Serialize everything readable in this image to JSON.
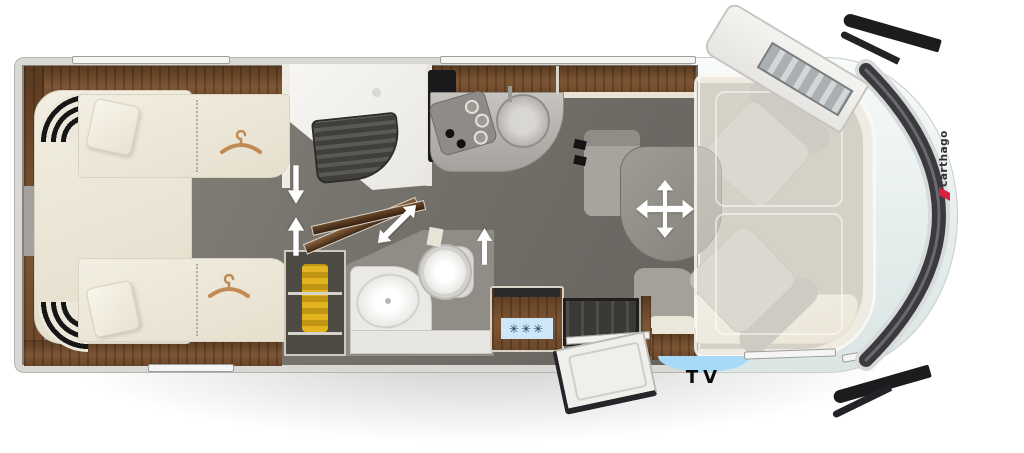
{
  "meta": {
    "type": "motorhome-floor-plan",
    "view": "top-down"
  },
  "labels": {
    "tv": "TV"
  },
  "brand": {
    "logo_text": "carthago",
    "logo_accent_color": "#d8203f"
  },
  "fridge": {
    "snowflakes": "✳✳✳",
    "panel_color": "#cde7f8",
    "snowflake_color": "#1c3050"
  },
  "icons": [
    {
      "name": "arrow-down-icon",
      "glyph": "↓"
    },
    {
      "name": "arrow-up-icon",
      "glyph": "↑"
    },
    {
      "name": "arrow-diagonal-icon",
      "glyph": "⤢"
    },
    {
      "name": "move-table-icon",
      "glyph": "✥"
    },
    {
      "name": "hanger-icon",
      "glyph": "⌒"
    },
    {
      "name": "snowflake-icon",
      "glyph": "✳"
    }
  ],
  "colors": {
    "wall": "#d9d8d5",
    "floor": "#726e68",
    "wood": "#6d4a2e",
    "upholstery": "#ece7da",
    "cab_body": "#eef4f3",
    "tv_marker": "#a7daf8",
    "accent_red": "#d8203f"
  }
}
